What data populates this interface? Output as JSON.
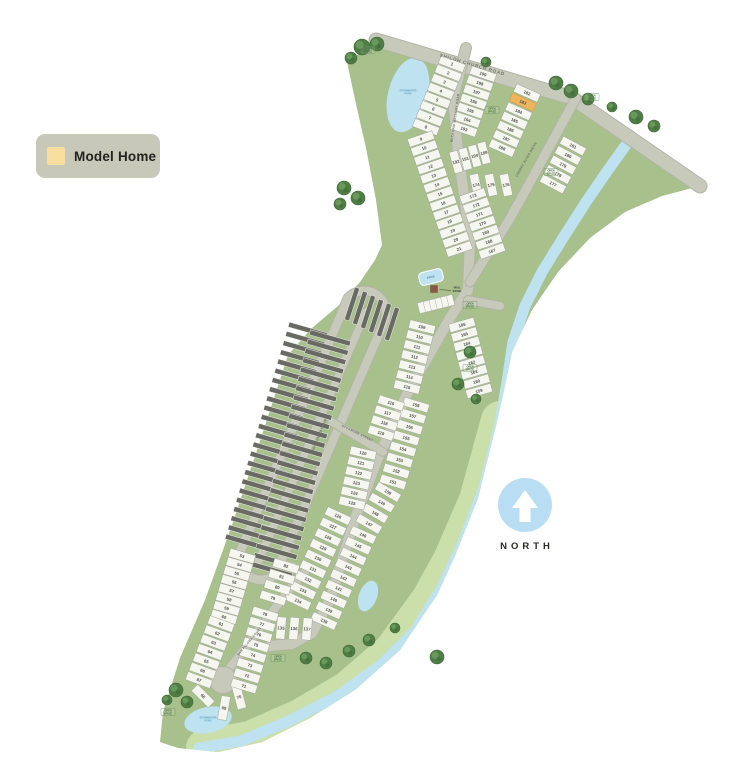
{
  "legend": {
    "label": "Model Home",
    "bg": "#c8c8b9",
    "swatch": "#f8dfa0"
  },
  "north": {
    "label": "NORTH",
    "circle": "#b9ddf2"
  },
  "colors": {
    "land": "#a7c08c",
    "land_light": "#cbdfaa",
    "road": "#c7c9bb",
    "casing": "#b2b4a6",
    "lot_fill": "#f6f6f0",
    "lot_stroke": "#a3a79a",
    "dark_lot": "#6a6a64",
    "water": "#bfe2f0",
    "model_fill": "#efb55c",
    "model_stroke": "#d79b3c",
    "number": "#50504a",
    "road_label": "#70766a",
    "open_space": "#466f3f",
    "pond_label": "#6aa3c2",
    "tree": "#4f7d45",
    "tree_inner": "#68985a",
    "tree_stroke": "#3e6837"
  },
  "map": {
    "land": [
      [
        347,
        62
      ],
      [
        383,
        38
      ],
      [
        576,
        96
      ],
      [
        700,
        186
      ],
      [
        662,
        196
      ],
      [
        625,
        212
      ],
      [
        590,
        238
      ],
      [
        558,
        272
      ],
      [
        532,
        310
      ],
      [
        512,
        352
      ],
      [
        503,
        395
      ],
      [
        495,
        430
      ],
      [
        478,
        498
      ],
      [
        455,
        556
      ],
      [
        437,
        595
      ],
      [
        400,
        650
      ],
      [
        355,
        690
      ],
      [
        310,
        718
      ],
      [
        262,
        742
      ],
      [
        218,
        752
      ],
      [
        178,
        748
      ],
      [
        160,
        742
      ],
      [
        163,
        712
      ],
      [
        180,
        658
      ],
      [
        205,
        600
      ],
      [
        232,
        525
      ],
      [
        262,
        435
      ],
      [
        288,
        355
      ],
      [
        312,
        328
      ],
      [
        338,
        306
      ],
      [
        360,
        282
      ],
      [
        375,
        260
      ],
      [
        382,
        245
      ],
      [
        376,
        200
      ],
      [
        366,
        148
      ],
      [
        356,
        104
      ]
    ],
    "land_light_band": [
      [
        500,
        420
      ],
      [
        478,
        500
      ],
      [
        452,
        560
      ],
      [
        430,
        600
      ],
      [
        392,
        652
      ],
      [
        348,
        690
      ],
      [
        300,
        718
      ],
      [
        250,
        740
      ],
      [
        205,
        748
      ]
    ],
    "creek": [
      [
        628,
        142
      ],
      [
        608,
        170
      ],
      [
        586,
        202
      ],
      [
        563,
        238
      ],
      [
        542,
        272
      ],
      [
        525,
        306
      ],
      [
        513,
        342
      ],
      [
        507,
        382
      ],
      [
        500,
        424
      ],
      [
        484,
        488
      ],
      [
        462,
        545
      ],
      [
        443,
        586
      ],
      [
        416,
        630
      ],
      [
        380,
        666
      ],
      [
        336,
        697
      ],
      [
        289,
        721
      ],
      [
        241,
        741
      ],
      [
        199,
        748
      ]
    ],
    "ponds": [
      {
        "x": 408,
        "y": 95,
        "rx": 20,
        "ry": 38,
        "rot": 14
      },
      {
        "x": 516,
        "y": 388,
        "rx": 8,
        "ry": 14,
        "rot": 10
      },
      {
        "x": 368,
        "y": 596,
        "rx": 9,
        "ry": 16,
        "rot": 20
      },
      {
        "x": 451,
        "y": 620,
        "rx": 10,
        "ry": 22,
        "rot": 22
      },
      {
        "x": 208,
        "y": 720,
        "rx": 24,
        "ry": 13,
        "rot": -12
      }
    ],
    "loop_road": {
      "path": "M348,298 A22,22 0 0 1 385,320 L275,575 A22,22 0 0 1 240,552 Z",
      "w": 8.5
    },
    "culdesac": {
      "x": 223,
      "y": 680,
      "r": 13
    },
    "roads": [
      {
        "id": "shiloh-church-road",
        "name": "SHILOH CHURCH ROAD",
        "pts": [
          [
            376,
            40
          ],
          [
            572,
            98
          ],
          [
            700,
            186
          ]
        ],
        "w": 13,
        "label": {
          "x": 472,
          "y": 66,
          "rot": 16.5,
          "size": 4.6,
          "ls": 0.8
        }
      },
      {
        "id": "beckham-mallory-road",
        "name": "BECKHAM MALLORY ROAD",
        "pts": [
          [
            466,
            48
          ],
          [
            453,
            98
          ],
          [
            458,
            152
          ],
          [
            470,
            238
          ],
          [
            468,
            290
          ],
          [
            450,
            318
          ],
          [
            408,
            392
          ],
          [
            378,
            458
          ],
          [
            356,
            516
          ],
          [
            342,
            560
          ],
          [
            330,
            600
          ],
          [
            312,
            633
          ],
          [
            292,
            644
          ],
          [
            270,
            646
          ]
        ],
        "w": 10,
        "label": {
          "x": 456,
          "y": 118,
          "rot": -82,
          "size": 3.2,
          "ls": 0.3
        }
      },
      {
        "id": "cherry-river-drive",
        "name": "CHERRY RIVER DRIVE",
        "pts": [
          [
            576,
            98
          ],
          [
            552,
            142
          ],
          [
            528,
            186
          ],
          [
            508,
            222
          ],
          [
            490,
            250
          ],
          [
            470,
            282
          ]
        ],
        "w": 9,
        "label": {
          "x": 527,
          "y": 160,
          "rot": -60,
          "size": 3.2,
          "ls": 0.3
        }
      },
      {
        "id": "mockingbird-court",
        "name": "MOCKINGBIRD COURT",
        "pts": [
          [
            366,
            312
          ],
          [
            258,
            562
          ]
        ],
        "w": 7.5,
        "label": {
          "x": 320,
          "y": 436,
          "rot": -67,
          "size": 3.2,
          "ls": 0.3
        }
      },
      {
        "id": "sycamore-street",
        "name": "SYCAMORE STREET",
        "pts": [
          [
            332,
            422
          ],
          [
            383,
            452
          ]
        ],
        "w": 7.5,
        "label": {
          "x": 357,
          "y": 434,
          "rot": 26,
          "size": 3,
          "ls": 0.3
        }
      },
      {
        "id": "san-paloma-court",
        "name": "SAN PALOMA COURT",
        "pts": [
          [
            305,
            572
          ],
          [
            293,
            585
          ],
          [
            266,
            620
          ],
          [
            240,
            655
          ],
          [
            228,
            670
          ]
        ],
        "w": 8,
        "label": {
          "x": 250,
          "y": 642,
          "rot": -50,
          "size": 3,
          "ls": 0.3
        }
      },
      {
        "id": "amenity-spur",
        "name": "",
        "pts": [
          [
            468,
            300
          ],
          [
            500,
            306
          ]
        ],
        "w": 8
      }
    ],
    "dark_bands": [
      {
        "sx": 308,
        "sy": 330,
        "ex": 245,
        "ey": 542,
        "count": 24,
        "w": 40,
        "h": 5,
        "rot": 16
      },
      {
        "sx": 330,
        "sy": 338,
        "ex": 272,
        "ey": 570,
        "count": 26,
        "w": 42,
        "h": 5,
        "rot": 16
      },
      {
        "sx": 352,
        "sy": 304,
        "ex": 392,
        "ey": 324,
        "count": 6,
        "w": 34,
        "h": 5,
        "rot": 108
      }
    ],
    "lot_groups": [
      {
        "from": 1,
        "to": 8,
        "sx": 452,
        "sy": 64,
        "ex": 426,
        "ey": 127,
        "rot": 21,
        "w": 26,
        "h": 8.5
      },
      {
        "from": 9,
        "to": 21,
        "sx": 421,
        "sy": 139,
        "ex": 459,
        "ey": 249,
        "rot": -19,
        "w": 26,
        "h": 8.5
      },
      {
        "from": 199,
        "to": 193,
        "sx": 483,
        "sy": 74,
        "ex": 464,
        "ey": 129,
        "rot": 19,
        "w": 26,
        "h": 8.5
      },
      {
        "from": 192,
        "to": 189,
        "sx": 456,
        "sy": 162,
        "ex": 484,
        "ey": 153,
        "rot": 75,
        "w": 22,
        "h": 8.5
      },
      {
        "from": 182,
        "to": 188,
        "sx": 527,
        "sy": 93,
        "ex": 502,
        "ey": 148,
        "rot": 24,
        "w": 26,
        "h": 8.5
      },
      {
        "from": 181,
        "to": 177,
        "sx": 573,
        "sy": 146,
        "ex": 553,
        "ey": 184,
        "rot": 28,
        "w": 26,
        "h": 8.5
      },
      {
        "from": 176,
        "to": 174,
        "sx": 506,
        "sy": 185,
        "ex": 476,
        "ey": 185,
        "rot": 78,
        "w": 22,
        "h": 9
      },
      {
        "from": 173,
        "to": 167,
        "sx": 473,
        "sy": 196,
        "ex": 492,
        "ey": 251,
        "rot": -19,
        "w": 26,
        "h": 8.5
      },
      {
        "from": 166,
        "to": 159,
        "sx": 462,
        "sy": 325,
        "ex": 479,
        "ey": 391,
        "rot": -16,
        "w": 26,
        "h": 8.5
      },
      {
        "from": 158,
        "to": 151,
        "sx": 416,
        "sy": 405,
        "ex": 393,
        "ey": 482,
        "rot": 17,
        "w": 26,
        "h": 8.5
      },
      {
        "from": 150,
        "to": 147,
        "sx": 388,
        "sy": 492,
        "ex": 369,
        "ey": 524,
        "rot": 30,
        "w": 26,
        "h": 8.5
      },
      {
        "from": 146,
        "to": 138,
        "sx": 363,
        "sy": 535,
        "ex": 324,
        "ey": 621,
        "rot": 24,
        "w": 26,
        "h": 8.5
      },
      {
        "from": 137,
        "to": 135,
        "sx": 307,
        "sy": 629,
        "ex": 281,
        "ey": 628,
        "rot": 95,
        "w": 22,
        "h": 9
      },
      {
        "from": 134,
        "to": 126,
        "sx": 298,
        "sy": 601,
        "ex": 338,
        "ey": 516,
        "rot": 25,
        "w": 26,
        "h": 8.5
      },
      {
        "from": 125,
        "to": 120,
        "sx": 352,
        "sy": 503,
        "ex": 363,
        "ey": 453,
        "rot": 13,
        "w": 26,
        "h": 8.5
      },
      {
        "from": 119,
        "to": 116,
        "sx": 381,
        "sy": 433,
        "ex": 391,
        "ey": 403,
        "rot": 18,
        "w": 26,
        "h": 8.5
      },
      {
        "from": 115,
        "to": 109,
        "sx": 407,
        "sy": 387,
        "ex": 422,
        "ey": 327,
        "rot": 14,
        "w": 26,
        "h": 8.5
      },
      {
        "from": 53,
        "to": 60,
        "sx": 242,
        "sy": 556,
        "ex": 224,
        "ey": 617,
        "rot": 16,
        "w": 26,
        "h": 8.5
      },
      {
        "from": 61,
        "to": 67,
        "sx": 221,
        "sy": 624,
        "ex": 199,
        "ey": 680,
        "rot": 20,
        "w": 26,
        "h": 8.5
      },
      {
        "from": 68,
        "to": 69,
        "sx": 203,
        "sy": 696,
        "ex": 224,
        "ey": 708,
        "rot": 45,
        "rot2": 100,
        "w": 24,
        "h": 9
      },
      {
        "from": 70,
        "to": 70,
        "sx": 239,
        "sy": 697,
        "ex": 239,
        "ey": 697,
        "rot": 75,
        "w": 24,
        "h": 9
      },
      {
        "from": 71,
        "to": 78,
        "sx": 244,
        "sy": 686,
        "ex": 265,
        "ey": 614,
        "rot": 17,
        "w": 26,
        "h": 8.5
      },
      {
        "from": 79,
        "to": 82,
        "sx": 273,
        "sy": 598,
        "ex": 286,
        "ey": 566,
        "rot": 17,
        "w": 26,
        "h": 8.5
      }
    ],
    "model_home_lot": 183,
    "trees": [
      [
        362,
        47,
        8
      ],
      [
        377,
        44,
        7
      ],
      [
        351,
        58,
        6
      ],
      [
        486,
        62,
        5
      ],
      [
        556,
        83,
        7
      ],
      [
        571,
        91,
        7
      ],
      [
        588,
        99,
        6
      ],
      [
        612,
        107,
        5
      ],
      [
        636,
        117,
        7
      ],
      [
        654,
        126,
        6
      ],
      [
        344,
        188,
        7
      ],
      [
        358,
        198,
        7
      ],
      [
        340,
        204,
        6
      ],
      [
        470,
        352,
        6
      ],
      [
        458,
        384,
        6
      ],
      [
        476,
        399,
        5
      ],
      [
        306,
        658,
        6
      ],
      [
        326,
        663,
        6
      ],
      [
        349,
        651,
        6
      ],
      [
        369,
        640,
        6
      ],
      [
        395,
        628,
        5
      ],
      [
        437,
        657,
        7
      ],
      [
        176,
        690,
        7
      ],
      [
        187,
        702,
        6
      ],
      [
        167,
        700,
        5
      ]
    ],
    "open_space_label": {
      "line1": "OPEN",
      "line2": "SPACE"
    },
    "open_space_positions": [
      [
        368,
        50
      ],
      [
        592,
        97
      ],
      [
        492,
        110
      ],
      [
        551,
        172
      ],
      [
        470,
        305
      ],
      [
        470,
        368
      ],
      [
        278,
        658
      ],
      [
        168,
        712
      ]
    ],
    "pond_label": {
      "line1": "STORMWATER",
      "line2": "POND"
    },
    "pond_label_positions": [
      [
        408,
        92
      ],
      [
        208,
        719
      ]
    ],
    "amenity": {
      "pool": {
        "x": 431,
        "y": 277,
        "w": 24,
        "h": 13,
        "rot": -14,
        "label": "POOL"
      },
      "kiosk": {
        "x": 434,
        "y": 289,
        "w": 7,
        "h": 7,
        "label_line1": "MAIL",
        "label_line2": "KIOSK"
      },
      "parking": {
        "x": 436,
        "y": 304,
        "w": 36,
        "h": 11,
        "rot": -14
      }
    }
  }
}
